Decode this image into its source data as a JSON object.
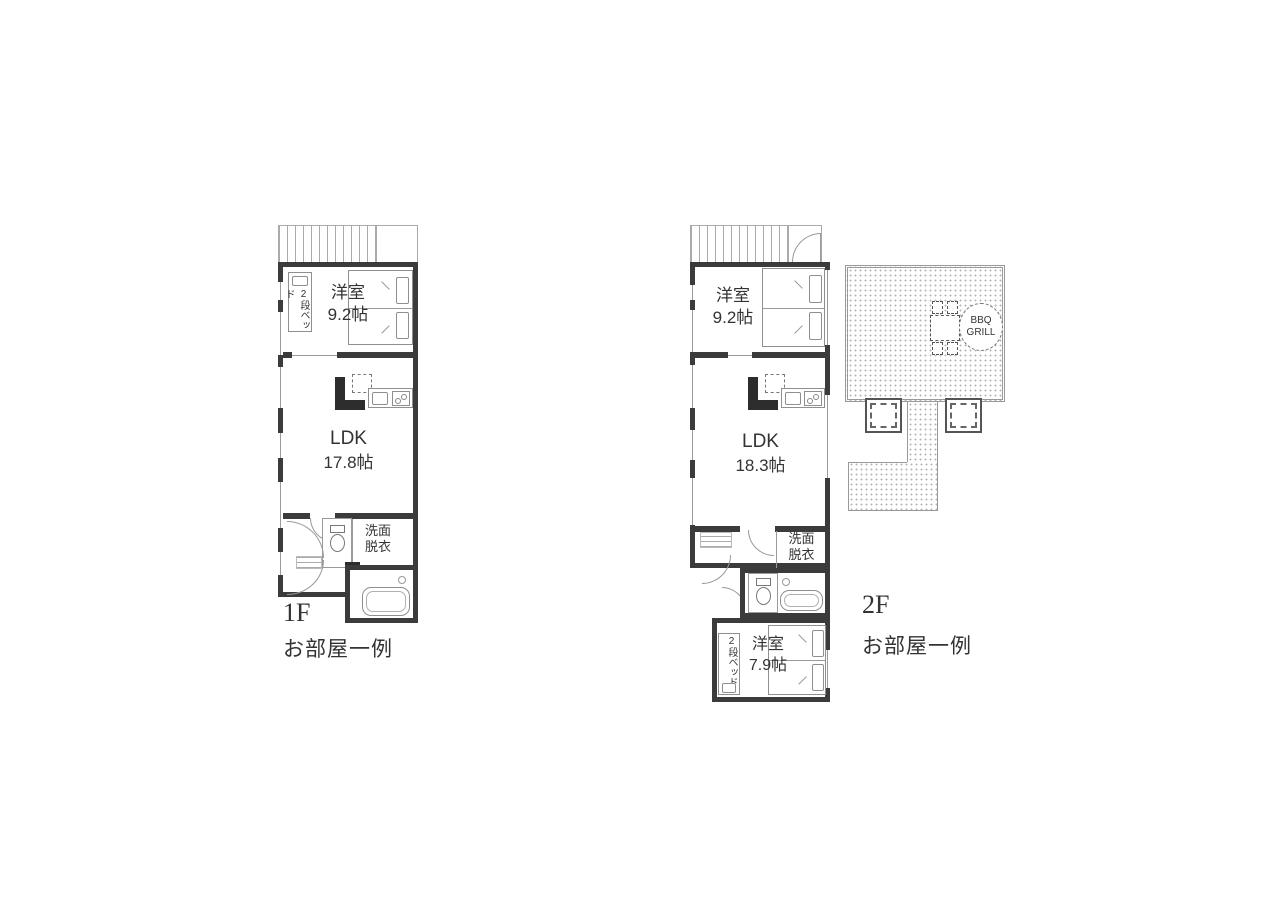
{
  "floor1": {
    "floor_label": "1F",
    "caption": "お部屋一例",
    "bedroom": {
      "name": "洋室",
      "size": "9.2帖"
    },
    "bunk_bed_label": "2段ベッド",
    "ldk": {
      "name": "LDK",
      "size": "17.8帖"
    },
    "washroom": {
      "line1": "洗面",
      "line2": "脱衣"
    }
  },
  "floor2": {
    "floor_label": "2F",
    "caption": "お部屋一例",
    "bedroom": {
      "name": "洋室",
      "size": "9.2帖"
    },
    "ldk": {
      "name": "LDK",
      "size": "18.3帖"
    },
    "washroom": {
      "line1": "洗面",
      "line2": "脱衣"
    },
    "bedroom2": {
      "name": "洋室",
      "size": "7.9帖"
    },
    "bunk_bed_label": "2段ベッド"
  },
  "deck": {
    "bbq": {
      "line1": "BBQ",
      "line2": "GRILL"
    }
  },
  "colors": {
    "wall": "#3b3b3b",
    "line": "#999999",
    "text": "#333333",
    "dots": "#b5b5b5"
  }
}
